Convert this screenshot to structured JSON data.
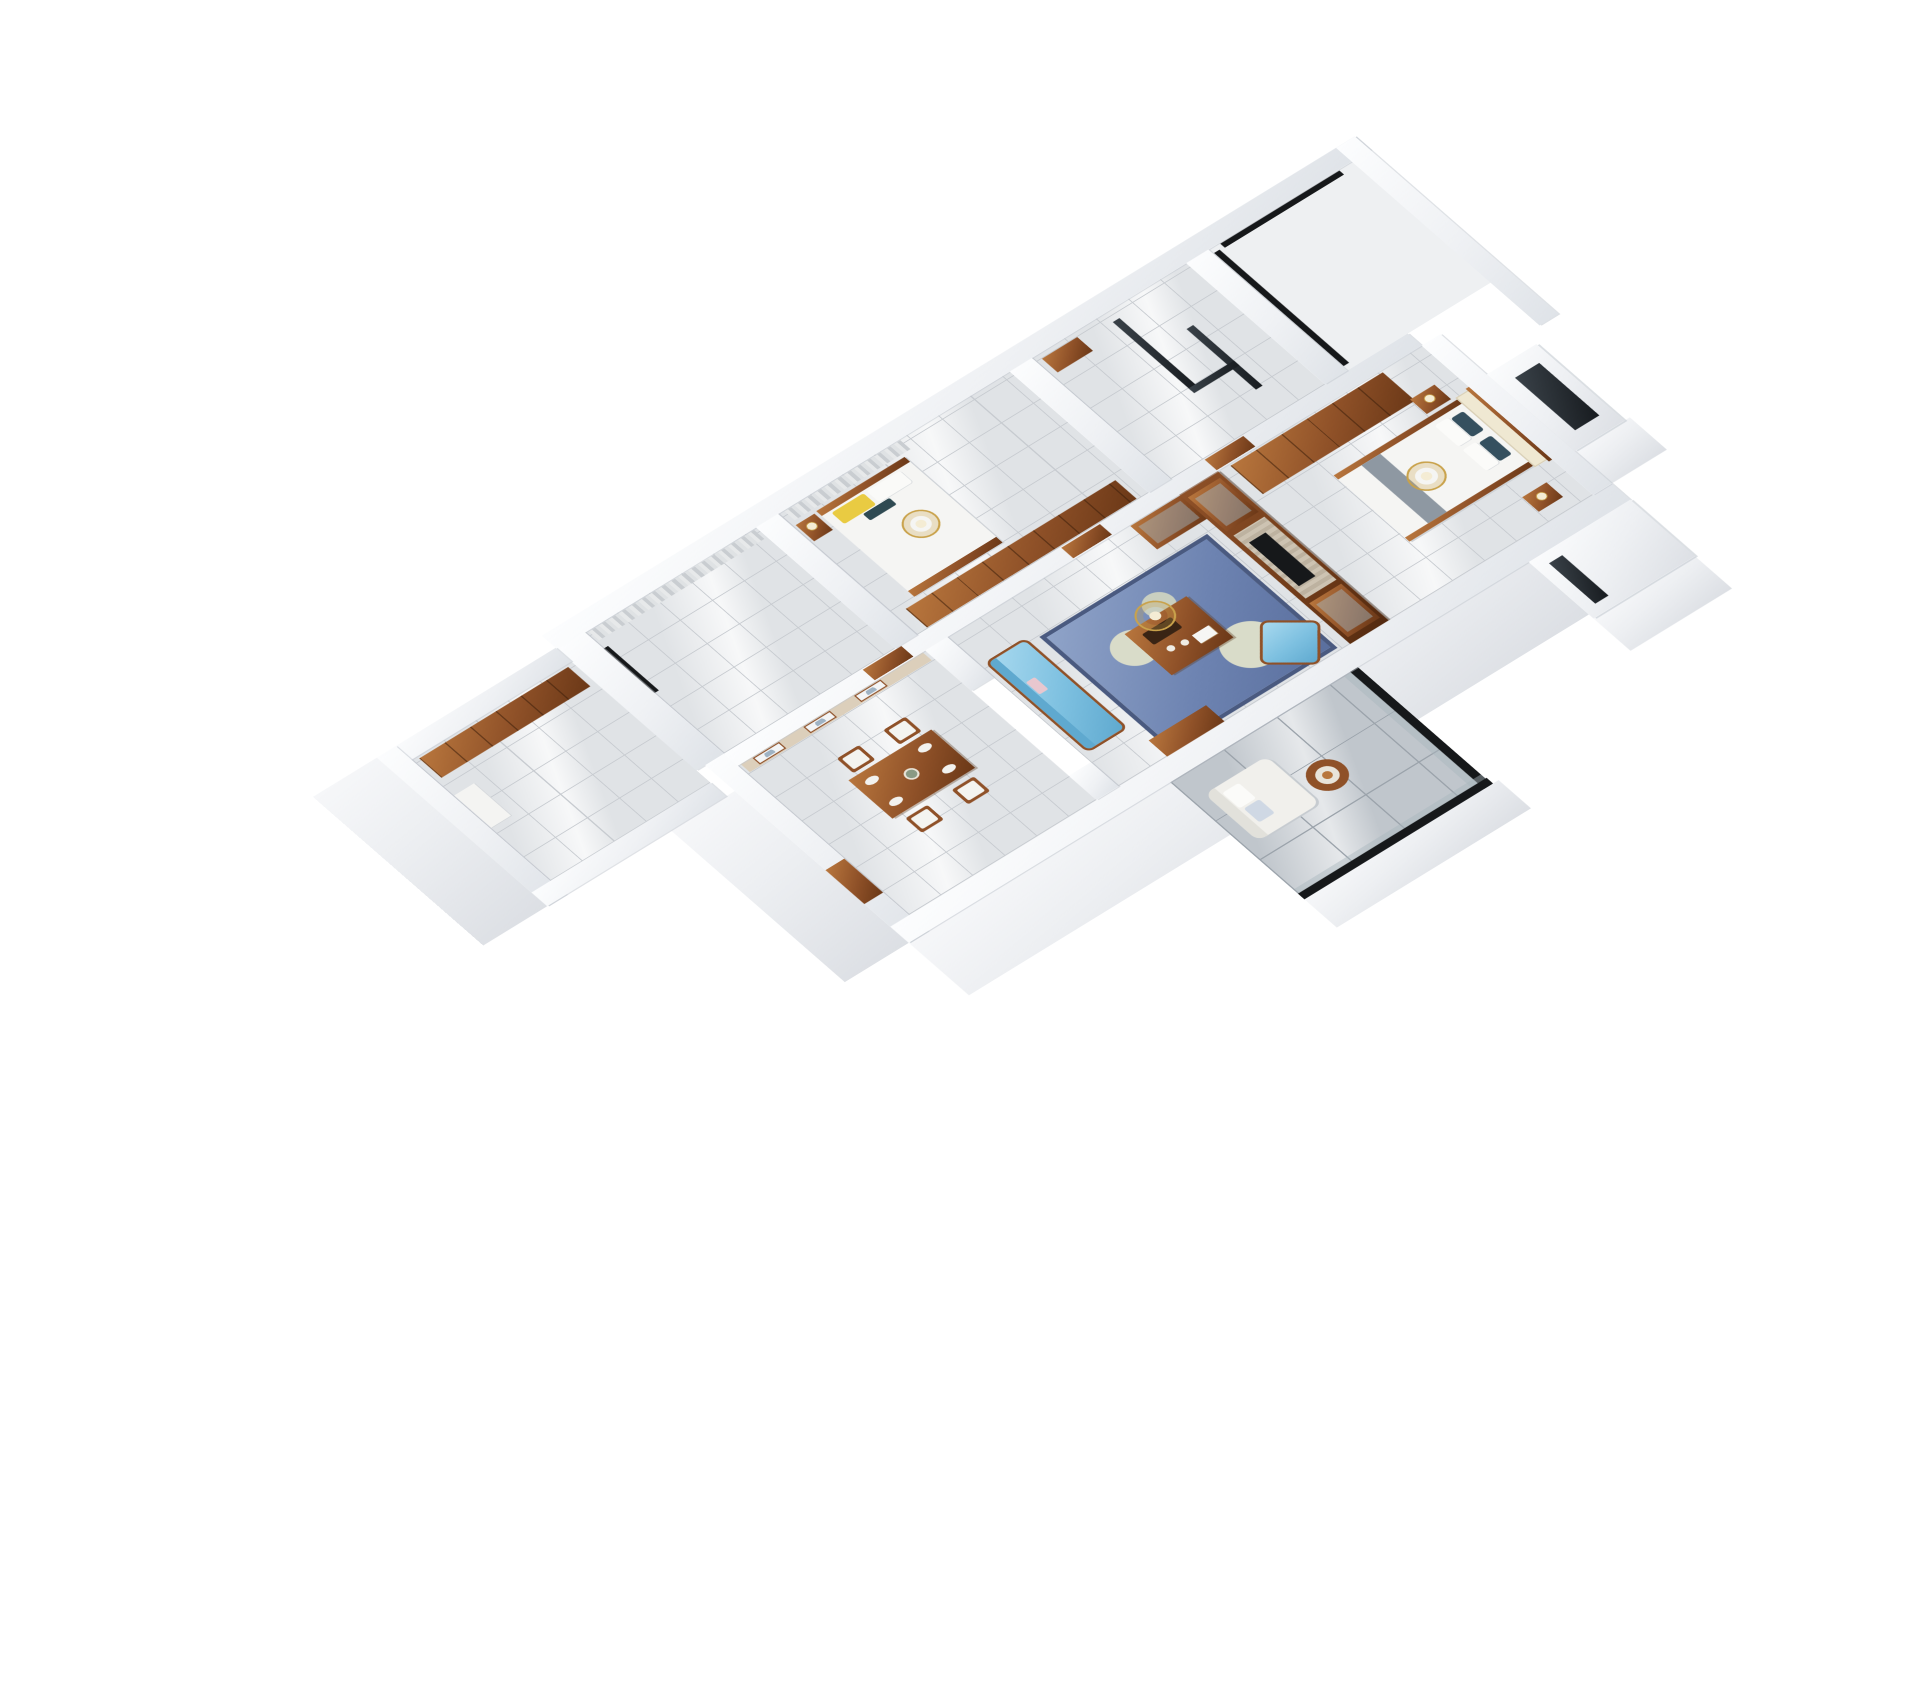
{
  "scene": {
    "type": "3D dollhouse floor-plan render",
    "view": "axonometric top-down cutaway, white background",
    "style": "classic red-wood furniture, white cut walls, glossy tile floors"
  },
  "palette": {
    "bg": "#ffffff",
    "wallHi": "#fcfdfe",
    "wallMid": "#eff1f4",
    "wallLo": "#dfe3e8",
    "wallShadow": "#c3c9d0",
    "floorTile": "#e0e3e6",
    "floorLine": "#c7cbd0",
    "balconyTile": "#c0c6cc",
    "balconyLine": "#9ba3ab",
    "woodHi": "#b8763d",
    "wood": "#8f5128",
    "woodLo": "#6b3817",
    "woodLine": "#3d1f0a",
    "beige": "#dccfbb",
    "cream": "#efe8d2",
    "slatHi": "#cdc3b2",
    "slatLo": "#bdb2a0",
    "sofaHi": "#a8d9ef",
    "sofa": "#7dc0e0",
    "sofaLo": "#5fa9cf",
    "rugHi": "#8fa3c8",
    "rug": "#6d83b1",
    "rugLo": "#5a6f9e",
    "rugBorder": "#4a5a80",
    "rugLeaf": "#d9dcc9",
    "gold": "#c9a24b",
    "lampCream": "#f4ecd4",
    "glassHi": "#3a4249",
    "glassLo": "#171b1f",
    "frameBlack": "#16181a",
    "bedding": "#f5f5f3",
    "pillowNavy": "#35505f",
    "pillowGray": "#8e98a2",
    "pillowYellow": "#e9cb42",
    "pillowTeal": "#2f4a52",
    "pillowPink": "#e8c7cf",
    "artBlue": "#9fb3c4"
  },
  "rooms": [
    {
      "name": "kitchen",
      "position": "far left wing",
      "features": [
        "wood wall cabinet",
        "white appliance",
        "window"
      ]
    },
    {
      "name": "study bedroom",
      "position": "upper left",
      "features": [
        "gray curtains",
        "black framed windows"
      ]
    },
    {
      "name": "second bedroom",
      "position": "top middle",
      "features": [
        "bed with yellow and white pillows",
        "teal accent pillow",
        "nightstand with lamp",
        "gold chandelier",
        "wood wardrobe",
        "curtains"
      ]
    },
    {
      "name": "bathroom",
      "position": "top right",
      "features": [
        "black framed glass shower partition",
        "wood vanity"
      ]
    },
    {
      "name": "utility balcony",
      "position": "far top right",
      "features": [
        "black window frame",
        "empty floor"
      ]
    },
    {
      "name": "dining room",
      "position": "center left",
      "features": [
        "wood dining table",
        "four chairs with white cushions",
        "three framed landscape artworks",
        "beige panel wall",
        "wood entrance door"
      ]
    },
    {
      "name": "living room",
      "position": "center",
      "features": [
        "blue tufted sofa",
        "blue leaf-pattern rug",
        "wood coffee table",
        "blue armchair",
        "gold chandelier",
        "wood TV media wall with glass display cabinets",
        "black TV on slat panel",
        "glass balcony door"
      ]
    },
    {
      "name": "master bedroom",
      "position": "right",
      "features": [
        "wood wardrobe",
        "bed with navy and white pillows",
        "cream panel headboard wall",
        "two nightstands with lamps",
        "gold chandelier",
        "white bay window volume"
      ]
    },
    {
      "name": "south balcony",
      "position": "bottom right",
      "features": [
        "large gray tiles",
        "white lounge chair with pillows",
        "round wood stool",
        "black framed glass railing"
      ]
    }
  ]
}
